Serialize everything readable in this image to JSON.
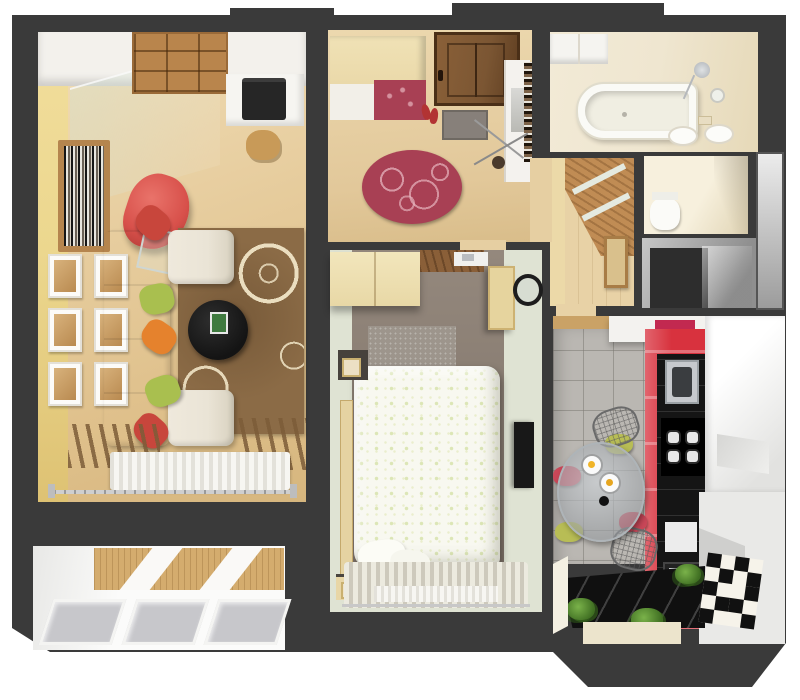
{
  "scene": {
    "type": "3d-floor-plan-top-view",
    "subject": "one-bedroom apartment interior render",
    "text_visible": "none"
  },
  "palette": {
    "wall": "#3a3a3a",
    "bg": "#ffffff",
    "yellow-wall": "#ecd78e",
    "sofa": "#eae4d6",
    "accent-red": "#d8323e",
    "rug-brown": "#8b6b46",
    "rug-red": "#a84054",
    "bedroom-floor": "#8b7f74",
    "bedroom-wall": "#dfe3d3",
    "kitchen-tile": "#bab7b2",
    "bath-beige": "#efe6d0",
    "balcony-glass": "#c7c7cb",
    "balcony-wood": "#d4ac6e",
    "panel-wood": "#c08c54",
    "duvet": "#f8f8f0",
    "counter-black": "#151515",
    "door-brown": "#7b5633"
  },
  "rooms": {
    "living_room": {
      "label": "living room",
      "pillow_colors": [
        "#c8463c",
        "#a9bf4f",
        "#e5822d",
        "#a9bf4f",
        "#c8463c"
      ],
      "picture_frames": {
        "rows": 3,
        "cols": 2
      },
      "furniture": [
        "corner sofa",
        "floral rug",
        "round coffee table",
        "red armchair",
        "bookshelf",
        "desk with printer",
        "cube shelving",
        "radiator",
        "window curtain rod"
      ]
    },
    "hallway": {
      "label": "hallway",
      "furniture": [
        "entrance door",
        "wardrobe with red bench",
        "oval red rug",
        "doormat",
        "console",
        "coat stand",
        "red shoes"
      ]
    },
    "bathroom": {
      "label": "bathroom",
      "furniture": [
        "bathtub",
        "shower",
        "twin sinks",
        "mirror",
        "cabinet",
        "towel"
      ]
    },
    "wc": {
      "label": "toilet room",
      "furniture": [
        "toilet"
      ]
    },
    "storage": {
      "label": "storage closet",
      "furniture": []
    },
    "corridor": {
      "label": "inner corridor",
      "furniture": [
        "wood slat wall panel",
        "frosted glass strips",
        "picture"
      ]
    },
    "bedroom": {
      "label": "bedroom",
      "furniture": [
        "double bed with leaf-pattern duvet",
        "wardrobe",
        "nightstands with lamps",
        "wall tv",
        "round mirror",
        "shag rug",
        "striped curtains",
        "radiator"
      ]
    },
    "kitchen": {
      "label": "kitchen",
      "burner_count": 4,
      "checker_pattern": [
        1,
        0,
        1,
        0,
        0,
        1,
        0,
        1,
        1,
        0,
        0,
        1,
        0,
        1,
        1,
        0,
        1,
        0,
        0,
        1
      ],
      "plates": 2,
      "plants": 3,
      "furniture": [
        "red cabinet run",
        "black countertop",
        "steel sink",
        "cooktop",
        "oven",
        "white upper cabinets",
        "round glass dining table",
        "wire chairs",
        "seat cushions",
        "bay window plants"
      ]
    },
    "balcony": {
      "label": "glazed balcony",
      "glazing_panels": 3
    }
  }
}
